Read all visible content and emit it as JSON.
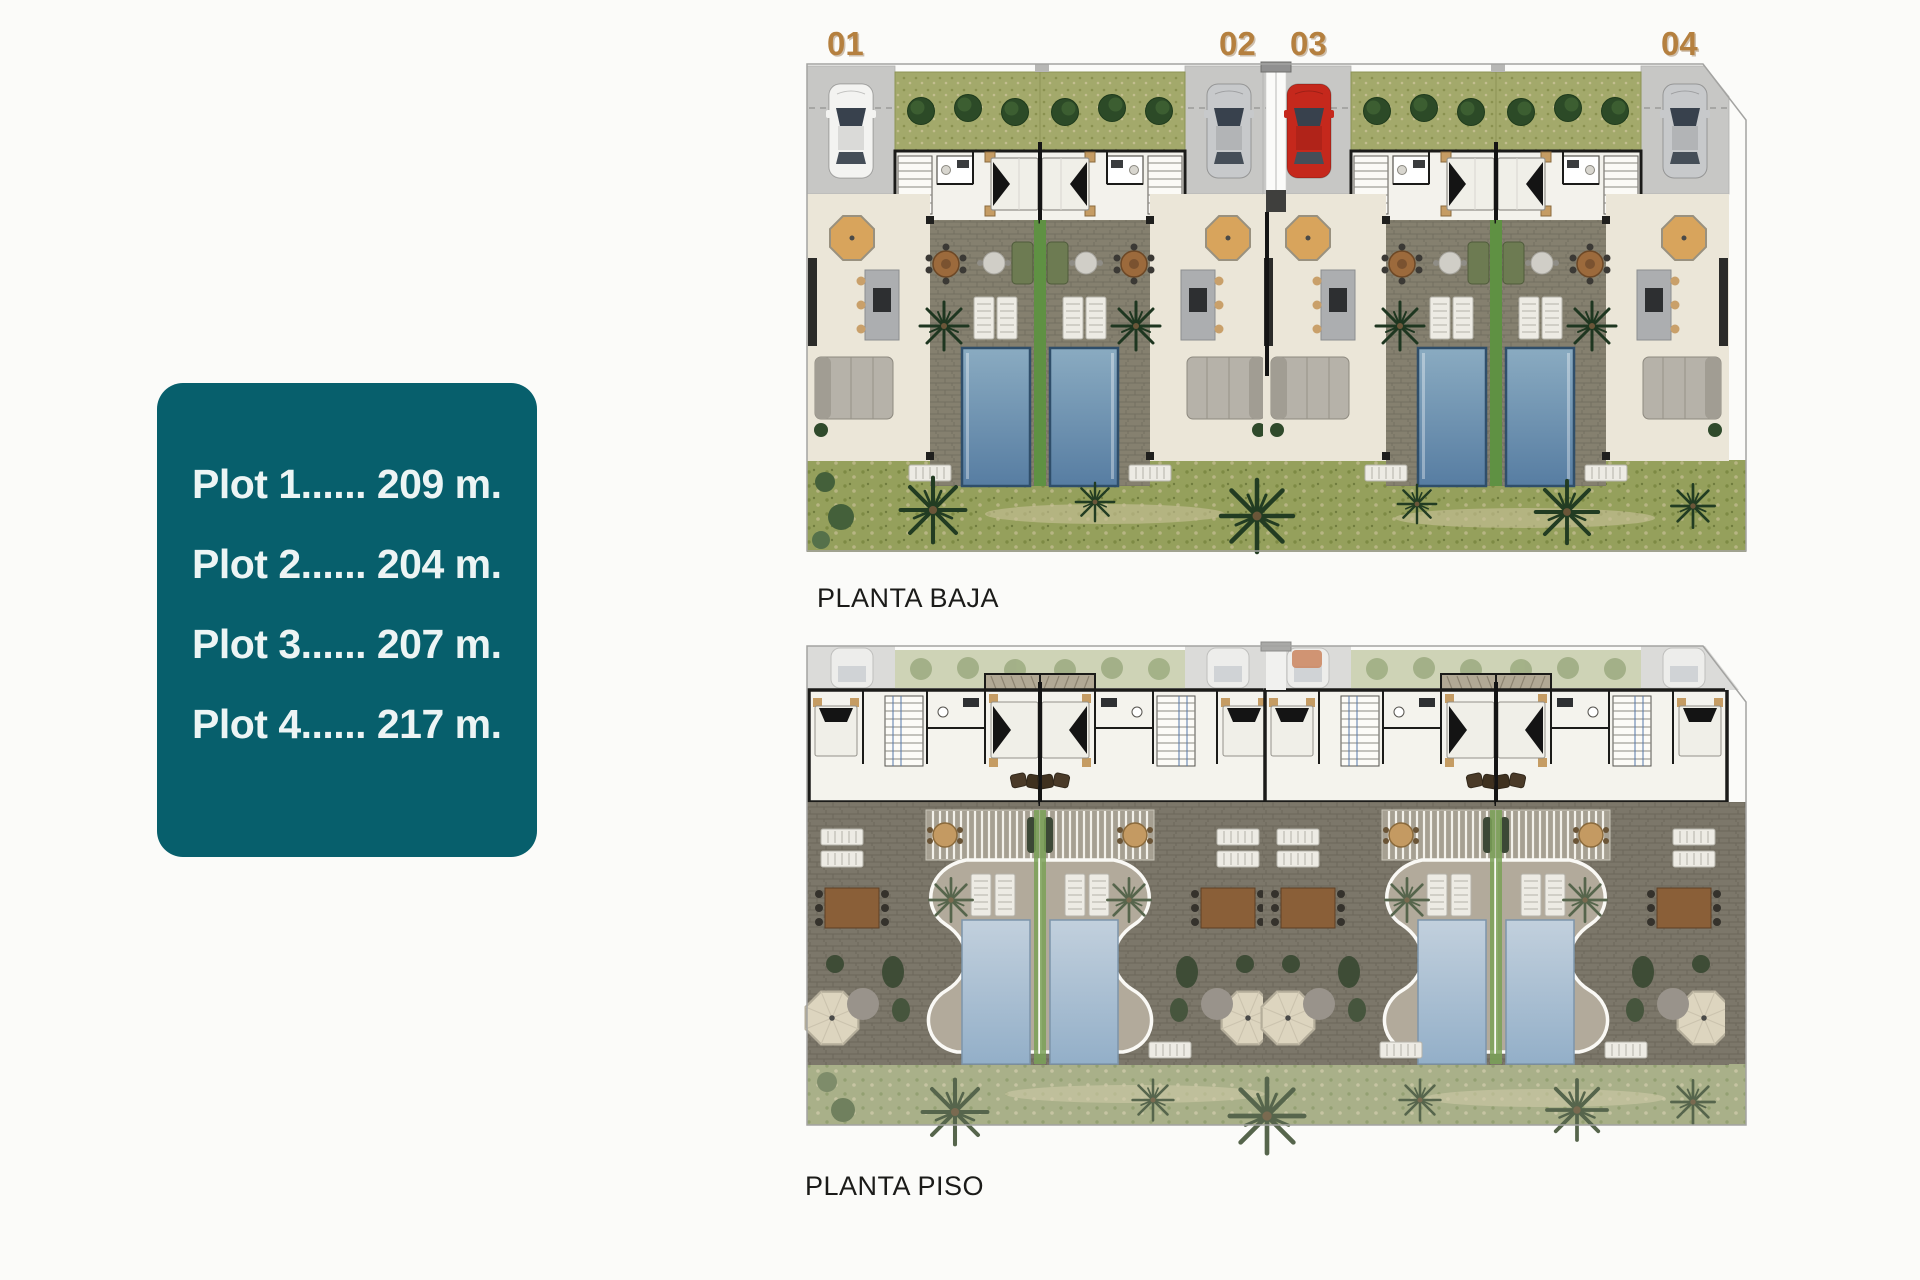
{
  "info_card": {
    "items": [
      "Plot 1...... 209 m.",
      "Plot 2...... 204 m.",
      "Plot 3...... 207 m.",
      "Plot 4...... 217 m."
    ]
  },
  "plans": {
    "ground": {
      "label": "PLANTA BAJA"
    },
    "upper": {
      "label": "PLANTA PISO"
    },
    "plot_numbers": [
      {
        "label": "01"
      },
      {
        "label": "02"
      },
      {
        "label": "03"
      },
      {
        "label": "04"
      }
    ]
  },
  "colors": {
    "card_bg": "#075f6c",
    "card_text": "#ecf4f4",
    "plot_number": "#b5803f",
    "title_text": "#1b1b19",
    "pool_ground": "#6f93b5",
    "pool_upper": "#a9bfd3",
    "patio_stone": "#85806f",
    "hedge_green": "#a3a96b",
    "garden_green": "#95a05c",
    "driveway_gray": "#c7c7c5",
    "red_car": "#c5281c"
  }
}
